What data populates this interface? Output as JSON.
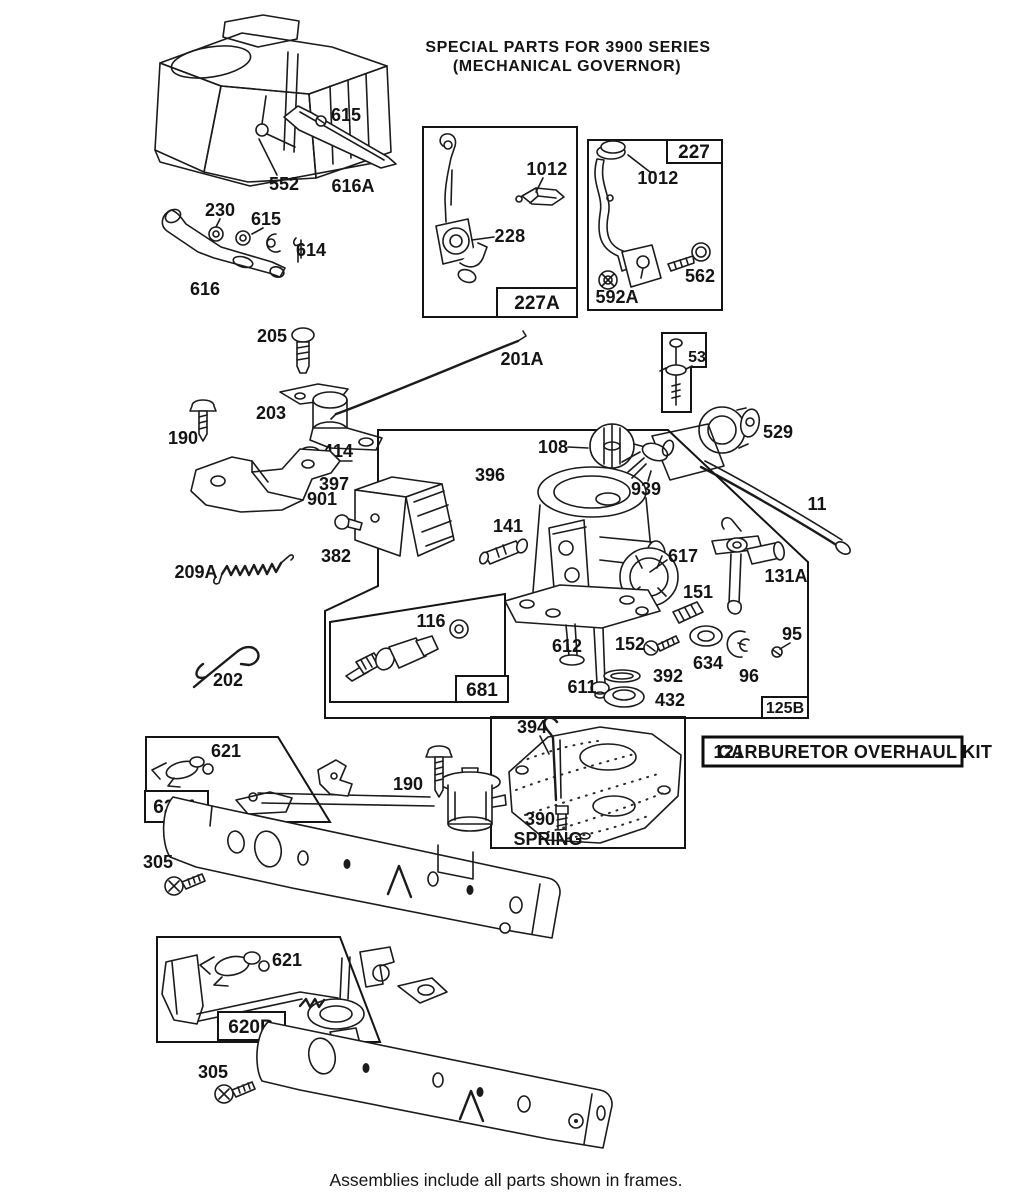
{
  "meta": {
    "ink": "#1b1b1b",
    "paper": "#ffffff"
  },
  "title": {
    "line1": "SPECIAL PARTS FOR 3900 SERIES",
    "line2": "(MECHANICAL GOVERNOR)"
  },
  "caption": "Assemblies include all parts shown in frames.",
  "kit_box": {
    "number": "121",
    "label": "CARBURETOR OVERHAUL KIT"
  },
  "frame_labels": {
    "f227A": "227A",
    "f227": "227",
    "f53": "53",
    "f681": "681",
    "f125B": "125B",
    "f620A": "620A",
    "f620B": "620B"
  },
  "part_labels": {
    "p615_top": "615",
    "p552": "552",
    "p616A": "616A",
    "p230": "230",
    "p615_mid": "615",
    "p614": "614",
    "p616": "616",
    "p1012_227A": "1012",
    "p228": "228",
    "p1012_227": "1012",
    "p562": "562",
    "p592A": "592A",
    "p205": "205",
    "p201A": "201A",
    "p203": "203",
    "p190_top": "190",
    "p414": "414",
    "p901": "901",
    "p529": "529",
    "p11": "11",
    "p209A": "209A",
    "p202": "202",
    "p108": "108",
    "p396": "396",
    "p397": "397",
    "p382": "382",
    "p141": "141",
    "p939": "939",
    "p617": "617",
    "p131A": "131A",
    "p151": "151",
    "p152": "152",
    "p116": "116",
    "p634": "634",
    "p96": "96",
    "p95": "95",
    "p612": "612",
    "p611": "611",
    "p392": "392",
    "p432": "432",
    "p394": "394",
    "p390": "390",
    "p390_word": "SPRING",
    "p621_top": "621",
    "p190_mid": "190",
    "p305_top": "305",
    "p621_bot": "621",
    "p305_bot": "305"
  }
}
